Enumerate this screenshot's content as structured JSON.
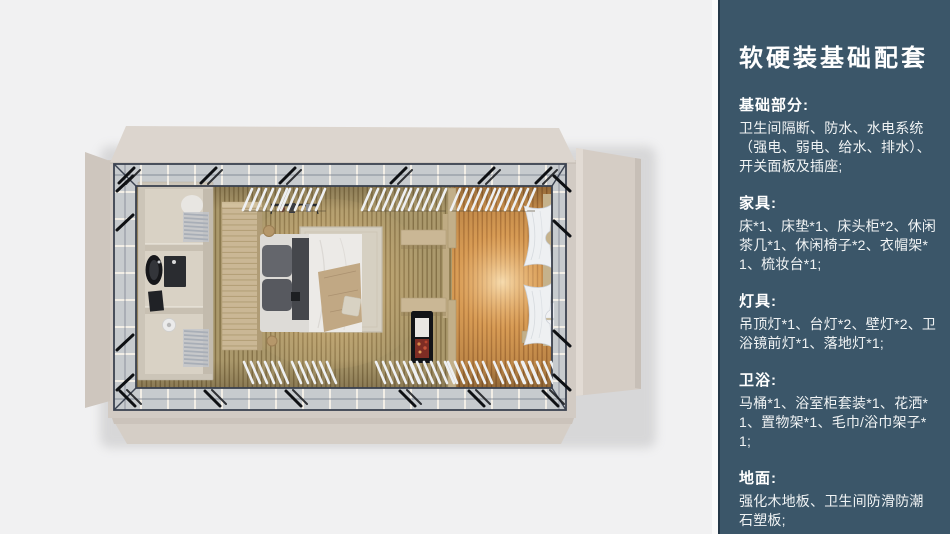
{
  "page": {
    "background": "#f1f1f2"
  },
  "panel": {
    "background": "#3b5669",
    "edge_color": "#fafafa",
    "text_color": "#ffffff",
    "title": "软硬装基础配套",
    "sections": [
      {
        "heading": "基础部分:",
        "body": "卫生间隔断、防水、水电系统（强电、弱电、给水、排水）、开关面板及插座;"
      },
      {
        "heading": "家具:",
        "body": "床*1、床垫*1、床头柜*2、休闲茶几*1、休闲椅子*2、衣帽架*1、梳妆台*1;"
      },
      {
        "heading": "灯具:",
        "body": "吊顶灯*1、台灯*2、壁灯*2、卫浴镜前灯*1、落地灯*1;"
      },
      {
        "heading": "卫浴:",
        "body": "马桶*1、浴室柜套装*1、花洒*1、置物架*1、毛巾/浴巾架子*1;"
      },
      {
        "heading": "地面:",
        "body": "强化木地板、卫生间防滑防潮石塑板;"
      }
    ]
  },
  "floorplan": {
    "description": "俯视3D渲染：客房单元，含卫生间、衣柜、双人床、壁炉与暖光阳光区",
    "colors": {
      "shell_beige": "#d3ccc5",
      "flap_light": "#dcd5ce",
      "frame_dark": "#3b4250",
      "glass": "#c7cbce",
      "floor_wood": "#ab996c",
      "warm_glow": "#f2ae5e",
      "bathroom_wall": "#ccc5b8",
      "bed_white": "#eceae7",
      "throw_beige": "#c1a884",
      "curtain_white": "#eef0f2"
    }
  }
}
